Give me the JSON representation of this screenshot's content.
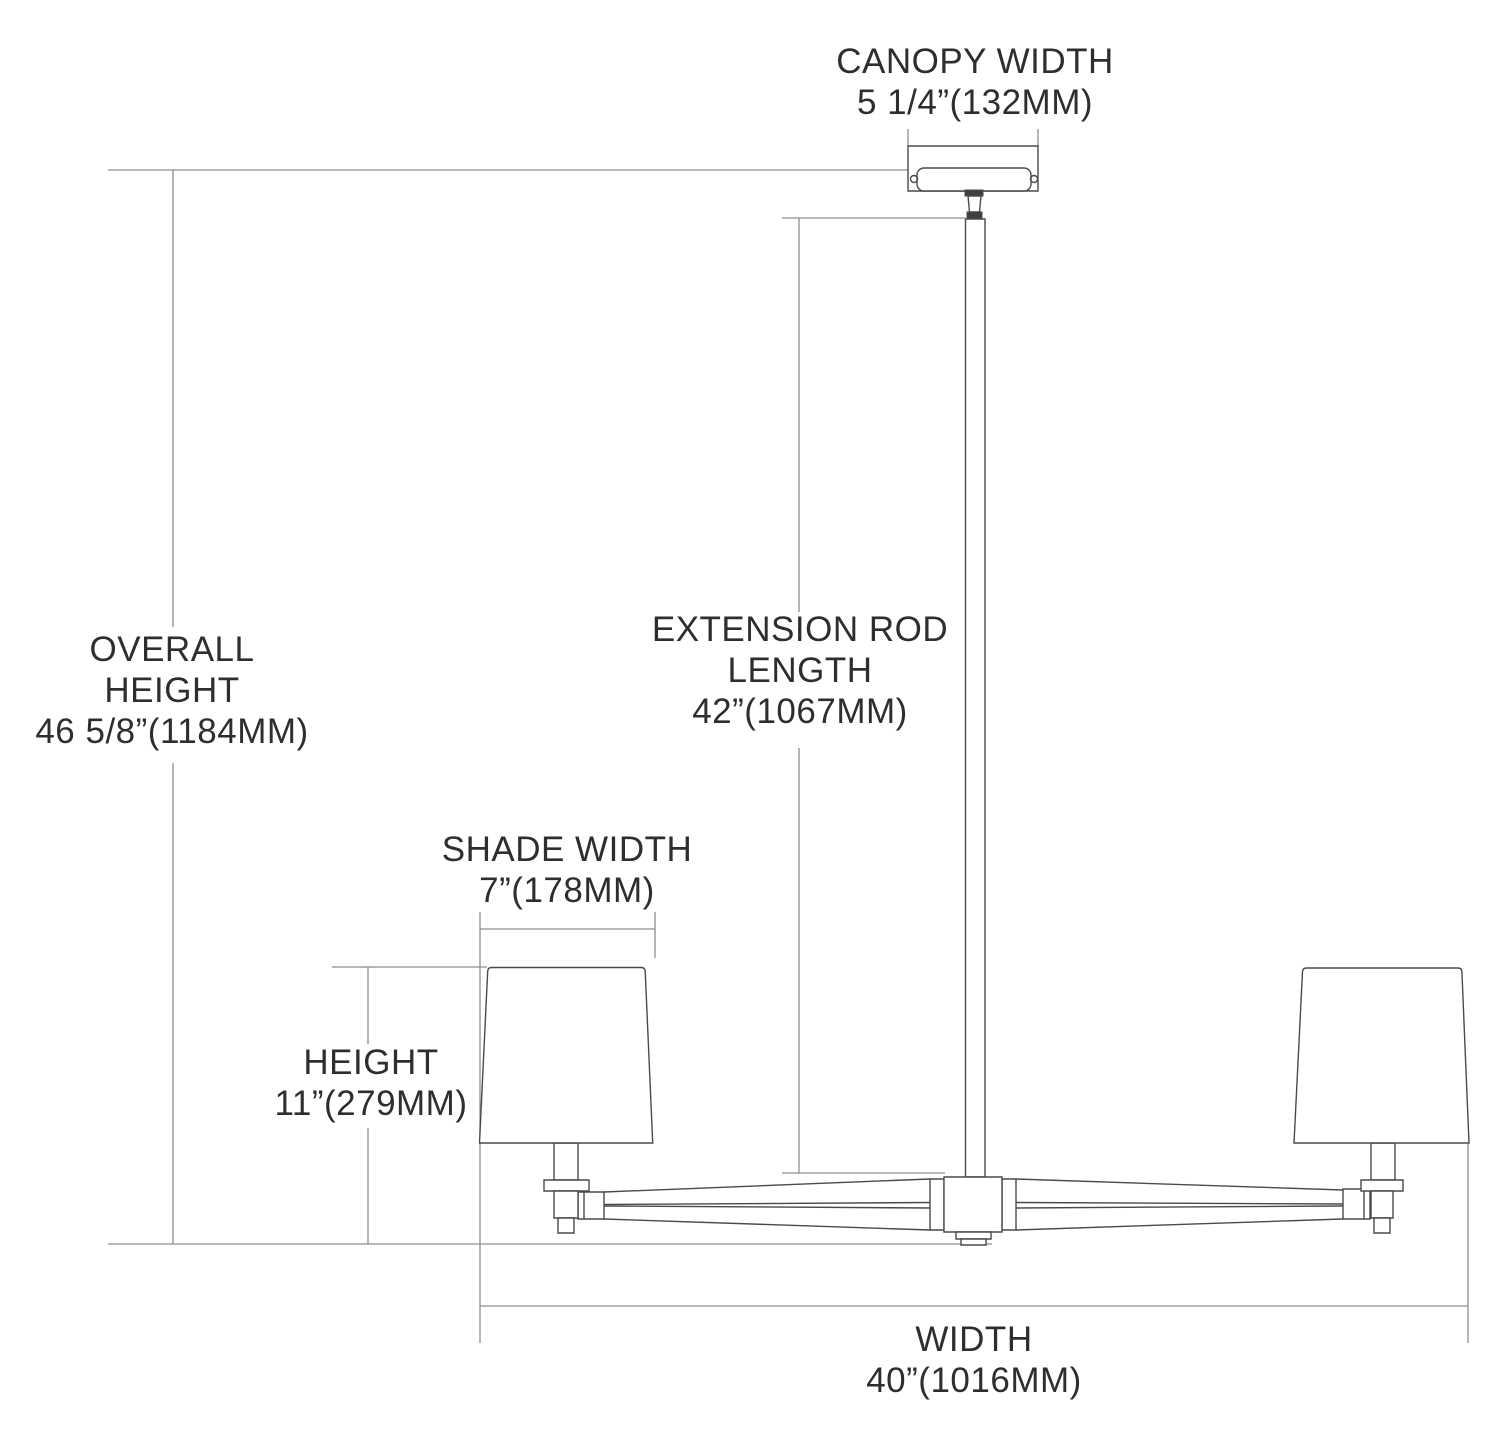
{
  "diagram": {
    "labels": {
      "canopy_width": {
        "lines": [
          "CANOPY WIDTH",
          "5 1/4”(132MM)"
        ]
      },
      "overall_height": {
        "lines": [
          "OVERALL",
          "HEIGHT",
          "46 5/8”(1184MM)"
        ]
      },
      "extension_rod_length": {
        "lines": [
          "EXTENSION ROD",
          "LENGTH",
          "42”(1067MM)"
        ]
      },
      "shade_width": {
        "lines": [
          "SHADE WIDTH",
          "7”(178MM)"
        ]
      },
      "height": {
        "lines": [
          "HEIGHT",
          "11”(279MM)"
        ]
      },
      "width": {
        "lines": [
          "WIDTH",
          "40”(1016MM)"
        ]
      }
    },
    "colors": {
      "background": "#ffffff",
      "fixture_line": "#4a4a4a",
      "dimension_line": "#8e8e8e",
      "text": "#2e2e2e"
    }
  }
}
